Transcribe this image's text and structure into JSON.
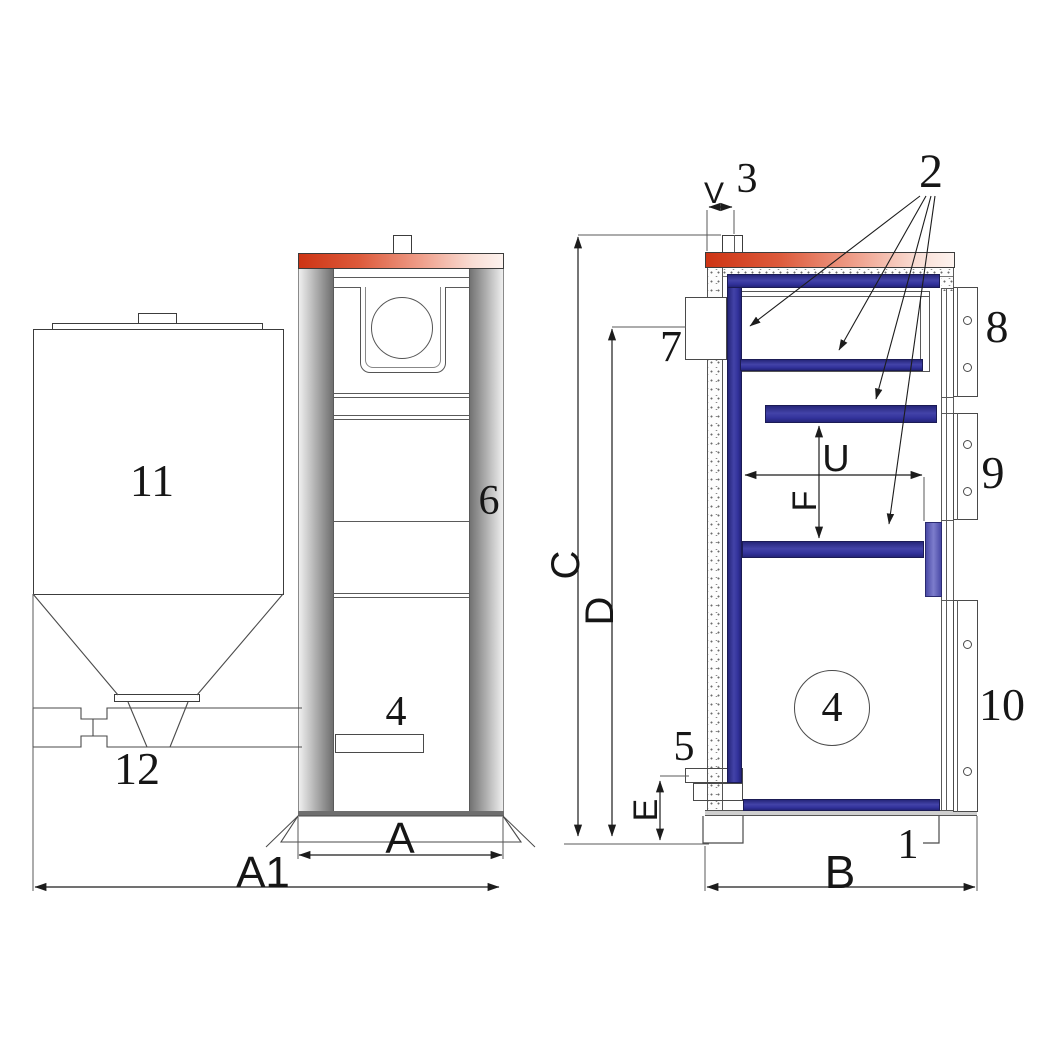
{
  "drawing": {
    "title": "Solid-fuel boiler with fuel hopper — dimensioned cross-section drawing",
    "views": {
      "hopper": "fuel hopper with cone outlet and auger feed",
      "front": "boiler front elevation",
      "side": "boiler side section"
    }
  },
  "part_labels": {
    "p1": "1",
    "p2": "2",
    "p3": "3",
    "p4_front": "4",
    "p4_side": "4",
    "p5": "5",
    "p6": "6",
    "p7": "7",
    "p8": "8",
    "p9": "9",
    "p10": "10",
    "p11": "11",
    "p12": "12"
  },
  "dim_labels": {
    "A": "A",
    "A1": "A1",
    "B": "B",
    "C": "C",
    "D": "D",
    "E": "E",
    "F": "F",
    "U": "U",
    "V": "V"
  },
  "colors": {
    "top_plate_red": "#cd3414",
    "water_jacket_blue": "#32329b",
    "side_plate_blue": "#5b5bb8",
    "column_gray": "#a8a8a8",
    "line_color": "#3c3c3c"
  }
}
